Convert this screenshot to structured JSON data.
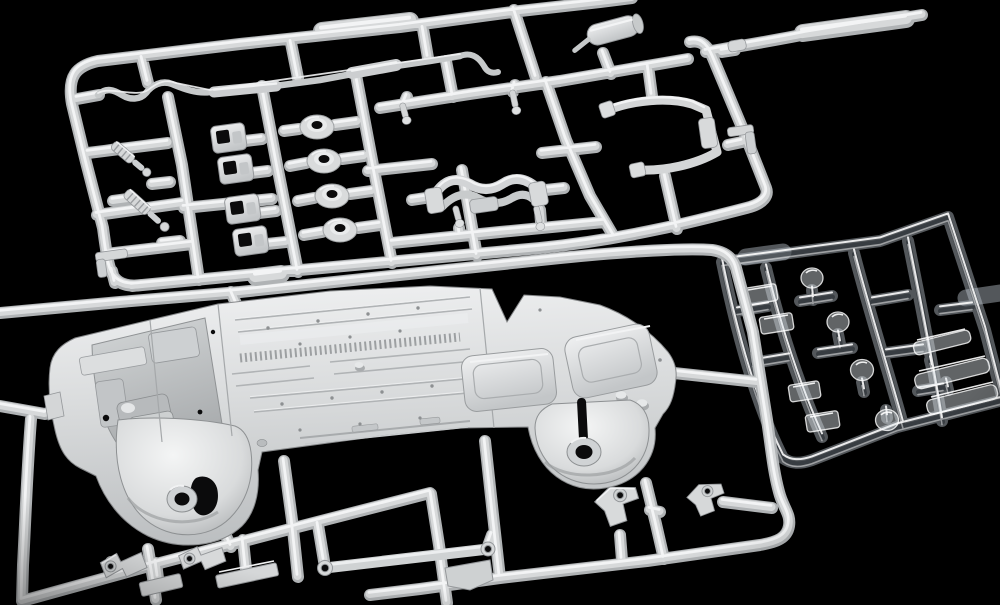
{
  "scene": {
    "type": "photograph",
    "description": "Overhead studio photograph of an unassembled plastic scale-model car kit on a black background: a large white injection-molded sprue of suspension and exhaust parts at top, a second white sprue carrying the one-piece chassis underbody with molded floor ribs, wheel wells and fuel tank across the middle, and a small translucent clear-parts sprue at the right.",
    "background_color": "#000000"
  },
  "palette": {
    "background": "#000000",
    "plastic_base": "#b0b3b5",
    "plastic_mid": "#d7d9da",
    "plastic_highlight": "#f3f4f5",
    "plastic_shadow": "#6f7274",
    "part_fill": "#d3d5d6",
    "part_stroke": "#94979a",
    "chassis_light": "#eceeef",
    "chassis_mid": "#d6d8d9",
    "chassis_dark": "#b9bcbe",
    "hole_black": "#0b0b0c",
    "clear_base": "rgba(198,208,216,0.42)",
    "clear_core": "rgba(25,30,36,0.45)",
    "clear_edge": "rgba(255,255,255,0.88)",
    "clear_fill": "rgba(230,238,244,0.42)"
  },
  "objects": {
    "top_sprue": {
      "label": "white sprue with suspension and exhaust parts",
      "parts": [
        "S-bend exhaust pipe",
        "muffler with tailpipe",
        "two coil-over shock absorbers",
        "four bushing mount boxes",
        "four round suspension bushings",
        "four locating pins",
        "suspension crossmember",
        "roll-bar bracket",
        "small brackets"
      ]
    },
    "chassis_sprue": {
      "label": "white sprue carrying the chassis underbody",
      "parts": [
        "one-piece chassis underbody",
        "front wheel well with hub",
        "rear wheel well with hub",
        "fuel tank",
        "ribbed floor pan",
        "engine bay detail",
        "suspension arm with eyelets",
        "flat links and brackets"
      ]
    },
    "clear_sprue": {
      "label": "translucent sprue with clear parts",
      "parts": [
        "four round lamp lenses",
        "four rectangular light bars",
        "three long window strips"
      ]
    }
  }
}
